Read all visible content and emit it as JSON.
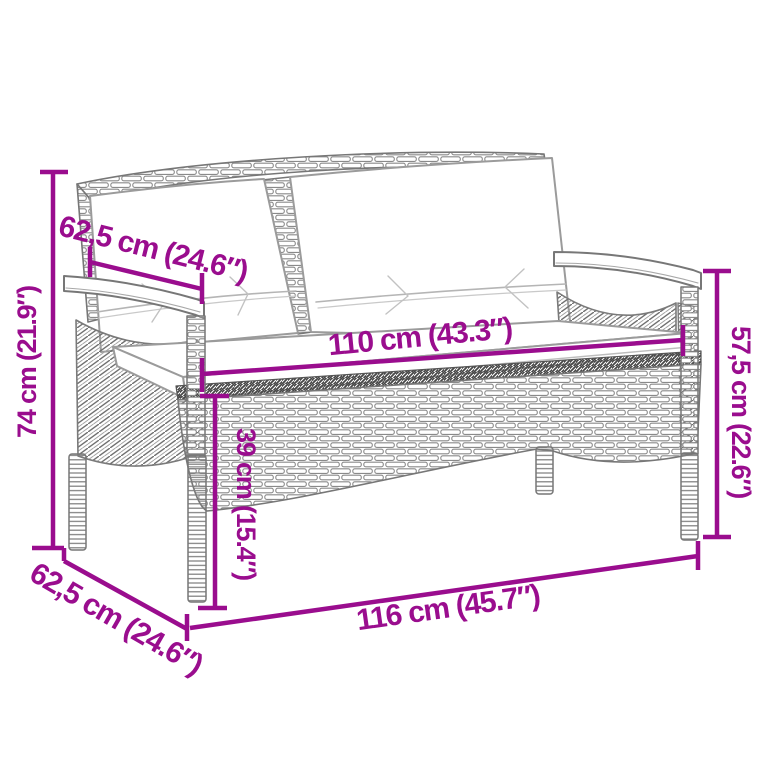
{
  "colors": {
    "dimension_accent": "#9A0D8E",
    "line_art_gray": "#6e6e6e",
    "cushion_outline": "#9b9b9b",
    "background": "#ffffff"
  },
  "diagram": {
    "type": "product-dimension-diagram",
    "subject": "rattan-bench-with-cushions-illustration",
    "labels": {
      "overall_height": "74 cm (21.9″)",
      "depth_upper": "62,5 cm (24.6″)",
      "seat_width": "110 cm (43.3″)",
      "seat_height": "39 cm (15.4″)",
      "armrest_height": "57,5 cm (22.6″)",
      "depth_lower": "62,5 cm (24.6″)",
      "overall_width": "116 cm (45.7″)"
    }
  }
}
